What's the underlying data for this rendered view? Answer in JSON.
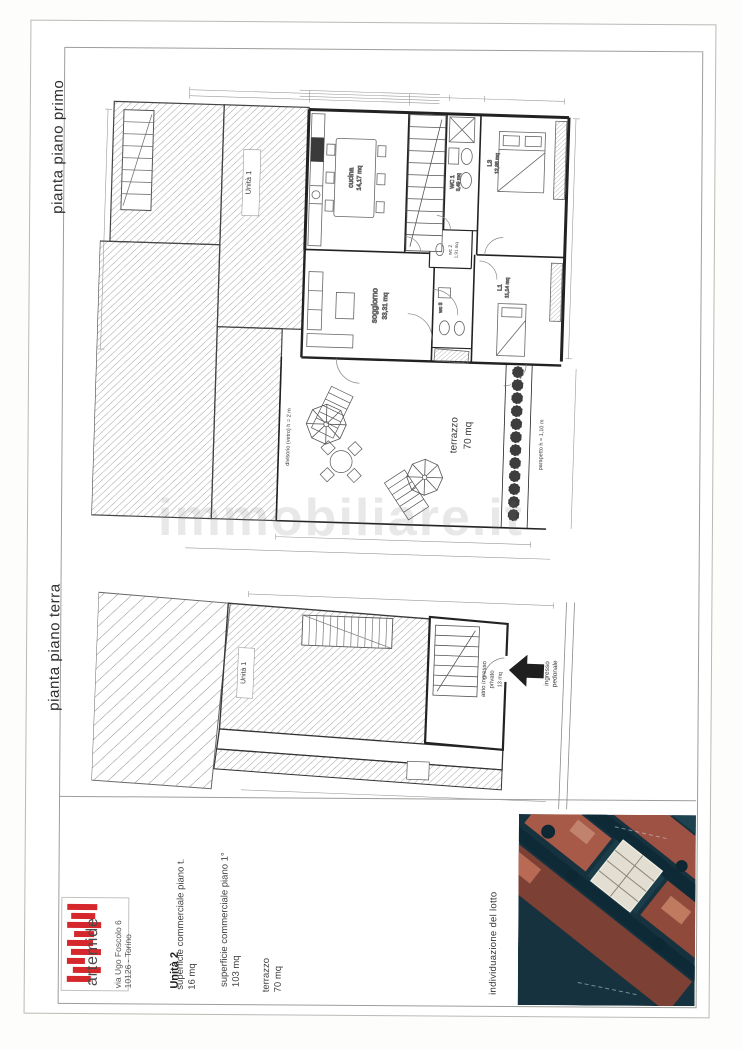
{
  "document": {
    "watermark": "immobiliare.it",
    "colors": {
      "logo_red": "#d6282c",
      "paper": "#ffffff",
      "line": "#2b2b2b"
    },
    "plans": {
      "first_floor": {
        "title": "pianta piano primo",
        "unita1": "Unità 1",
        "cucina": {
          "name": "cucina",
          "area": "14,17 mq"
        },
        "soggiorno": {
          "name": "soggiorno",
          "area": "33,31 mq"
        },
        "wc1": {
          "name": "WC 1",
          "area": "3,49 mq"
        },
        "wc2": {
          "name": "wc 2",
          "area": "1,91 mq"
        },
        "wc3": {
          "name": "wc 3"
        },
        "l3": {
          "name": "L3",
          "area": "12,88 mq"
        },
        "l1": {
          "name": "L1",
          "area": "11,14 mq"
        },
        "terrazzo": {
          "name": "terrazzo",
          "area": "70 mq"
        },
        "divisorio": "divisorio (vetro) h = 2 m",
        "parapetto": "parapetto h = 1,10 m"
      },
      "ground_floor": {
        "title": "pianta piano terra",
        "unita1": "Unità 1",
        "atrio": {
          "line1": "atrio ingresso",
          "line2": "privato",
          "line3": "13 mq"
        },
        "ingresso": {
          "line1": "ingresso",
          "line2": "pedonale"
        }
      }
    },
    "footer": {
      "logo": "artemide",
      "address1": "via Ugo Foscolo 6",
      "address2": "10126 - Torino",
      "unit": "Unità 2",
      "rows": [
        {
          "label": "superficie commerciale piano t.",
          "value": "16 mq"
        },
        {
          "label": "superficie commerciale piano 1°",
          "value": "103 mq"
        },
        {
          "label": "terrazzo",
          "value": "70 mq"
        }
      ],
      "lot": "individuazione del lotto"
    }
  }
}
